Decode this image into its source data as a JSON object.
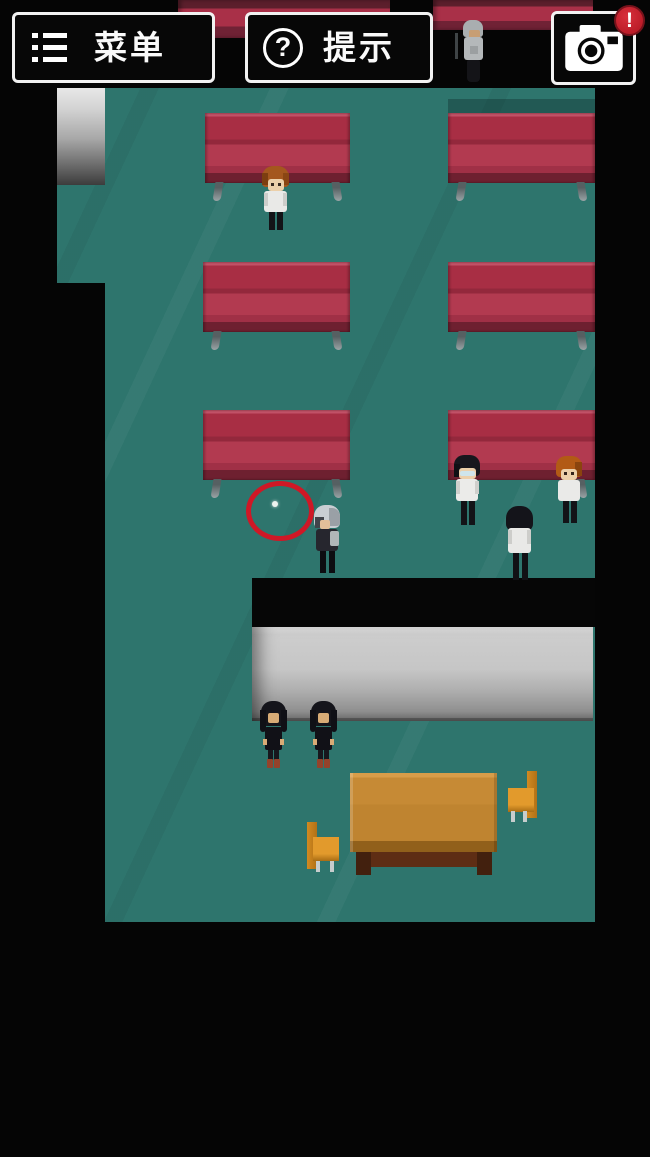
{
  "hud": {
    "menu_button": {
      "label": "菜单",
      "icon": "list-icon"
    },
    "hint_button": {
      "label": "提示",
      "icon": "question-circle-icon",
      "icon_char": "?"
    },
    "camera_button": {
      "icon": "camera-icon",
      "badge": "!"
    }
  },
  "palette": {
    "floor": "#2e756d",
    "bench_red": "#a82e44",
    "marker_red": "#cf1826",
    "wall_gray": "#c6c6c6",
    "table_wood": "#c68a35",
    "hud_border": "#f2f2f2",
    "badge_red": "#b01420"
  },
  "scene": {
    "benches": [
      {
        "name": "bench-top-left-partial",
        "x": 178,
        "y": 0,
        "w": 212,
        "h": 38,
        "partial": true
      },
      {
        "name": "bench-top-right-partial",
        "x": 433,
        "y": 0,
        "w": 160,
        "h": 30,
        "partial": true
      },
      {
        "name": "bench-row1-left",
        "x": 205,
        "y": 113,
        "w": 145
      },
      {
        "name": "bench-row1-right",
        "x": 448,
        "y": 113,
        "w": 147
      },
      {
        "name": "bench-row2-left",
        "x": 203,
        "y": 262,
        "w": 147
      },
      {
        "name": "bench-row2-right",
        "x": 448,
        "y": 262,
        "w": 147
      },
      {
        "name": "bench-row3-left",
        "x": 203,
        "y": 410,
        "w": 147
      },
      {
        "name": "bench-row3-right",
        "x": 448,
        "y": 410,
        "w": 147
      }
    ],
    "characters": [
      {
        "name": "npc-gray-hair-cane",
        "x": 460,
        "y": 20,
        "w": 26,
        "h": 62,
        "blocks": [
          [
            -5,
            13,
            3,
            26,
            "#3f4446",
            ""
          ],
          [
            3,
            0,
            20,
            17,
            "#a9aeb0",
            "8px 8px 3px 3px"
          ],
          [
            9,
            10,
            11,
            9,
            "#c79e74",
            "2px"
          ],
          [
            4,
            17,
            19,
            23,
            "#b4b8ba",
            "3px"
          ],
          [
            10,
            26,
            8,
            8,
            "#9b9fa1",
            ""
          ],
          [
            7,
            40,
            13,
            22,
            "#141418",
            "2px 2px 4px 4px"
          ]
        ]
      },
      {
        "name": "npc-brown-hair",
        "x": 261,
        "y": 166,
        "w": 29,
        "h": 66,
        "blocks": [
          [
            1,
            0,
            27,
            21,
            "#a4571e",
            "11px 11px 4px 4px"
          ],
          [
            1,
            7,
            6,
            12,
            "#7c3e10",
            ""
          ],
          [
            22,
            7,
            6,
            12,
            "#8a4614",
            ""
          ],
          [
            7,
            13,
            16,
            12,
            "#ecd0aa",
            "3px"
          ],
          [
            10,
            17,
            3,
            3,
            "#372a20",
            ""
          ],
          [
            17,
            17,
            3,
            3,
            "#372a20",
            ""
          ],
          [
            3,
            25,
            23,
            21,
            "#e9e9e7",
            "3px"
          ],
          [
            3,
            27,
            4,
            13,
            "#cdcdca",
            ""
          ],
          [
            22,
            27,
            4,
            13,
            "#cdcdca",
            ""
          ],
          [
            8,
            46,
            6,
            18,
            "#131317",
            ""
          ],
          [
            16,
            46,
            6,
            18,
            "#131317",
            ""
          ]
        ]
      },
      {
        "name": "player-silver-hair",
        "x": 312,
        "y": 505,
        "w": 30,
        "h": 68,
        "blocks": [
          [
            2,
            0,
            26,
            23,
            "#c9ced3",
            "11px 11px 5px 5px"
          ],
          [
            17,
            3,
            11,
            18,
            "#9aa0a6",
            "0 8px 3px 0"
          ],
          [
            3,
            12,
            9,
            11,
            "#41444b",
            ""
          ],
          [
            8,
            15,
            10,
            9,
            "#e2c09a",
            "2px"
          ],
          [
            4,
            24,
            22,
            22,
            "#26262e",
            "3px"
          ],
          [
            18,
            26,
            9,
            15,
            "#b0b6b8",
            "2px"
          ],
          [
            8,
            46,
            6,
            22,
            "#0d0d11",
            ""
          ],
          [
            17,
            46,
            6,
            22,
            "#0d0d11",
            ""
          ]
        ]
      },
      {
        "name": "npc-glasses",
        "x": 452,
        "y": 455,
        "w": 30,
        "h": 70,
        "blocks": [
          [
            2,
            0,
            26,
            21,
            "#17171d",
            "10px 10px 4px 4px"
          ],
          [
            2,
            9,
            6,
            13,
            "#101015",
            ""
          ],
          [
            7,
            13,
            17,
            11,
            "#ecd0aa",
            "3px"
          ],
          [
            8,
            16,
            15,
            5,
            "#cfe5eb",
            "2px"
          ],
          [
            4,
            24,
            22,
            22,
            "#ebebe9",
            "3px"
          ],
          [
            4,
            26,
            4,
            13,
            "#cfcfcc",
            ""
          ],
          [
            23,
            26,
            4,
            13,
            "#cfcfcc",
            ""
          ],
          [
            9,
            46,
            6,
            24,
            "#131317",
            ""
          ],
          [
            17,
            46,
            6,
            24,
            "#131317",
            ""
          ]
        ]
      },
      {
        "name": "npc-orange-hair",
        "x": 555,
        "y": 456,
        "w": 28,
        "h": 67,
        "blocks": [
          [
            1,
            0,
            26,
            21,
            "#b25a15",
            "10px 10px 4px 4px"
          ],
          [
            20,
            6,
            7,
            14,
            "#8a440e",
            ""
          ],
          [
            6,
            13,
            16,
            11,
            "#ecd0aa",
            "3px"
          ],
          [
            9,
            16,
            3,
            3,
            "#33241c",
            ""
          ],
          [
            16,
            16,
            3,
            3,
            "#33241c",
            ""
          ],
          [
            3,
            24,
            22,
            21,
            "#eaeae8",
            "3px"
          ],
          [
            8,
            45,
            6,
            22,
            "#131317",
            ""
          ],
          [
            16,
            45,
            6,
            22,
            "#131317",
            ""
          ]
        ]
      },
      {
        "name": "npc-back-view",
        "x": 504,
        "y": 506,
        "w": 31,
        "h": 74,
        "blocks": [
          [
            2,
            0,
            27,
            25,
            "#14141a",
            "12px 12px 7px 7px"
          ],
          [
            4,
            22,
            23,
            25,
            "#e9e9e7",
            "3px"
          ],
          [
            4,
            24,
            4,
            14,
            "#cdcdca",
            ""
          ],
          [
            23,
            24,
            4,
            14,
            "#cdcdca",
            ""
          ],
          [
            9,
            47,
            6,
            27,
            "#111115",
            ""
          ],
          [
            18,
            47,
            6,
            27,
            "#111115",
            ""
          ]
        ]
      },
      {
        "name": "npc-girl-black-dress-1",
        "x": 259,
        "y": 701,
        "w": 29,
        "h": 67,
        "blocks": [
          [
            2,
            0,
            25,
            25,
            "#15151b",
            "11px 11px 5px 5px"
          ],
          [
            1,
            9,
            6,
            22,
            "#101016",
            "0 0 3px 3px"
          ],
          [
            22,
            9,
            6,
            22,
            "#101016",
            "0 0 3px 3px"
          ],
          [
            9,
            12,
            11,
            10,
            "#d8ac76",
            "2px"
          ],
          [
            6,
            26,
            17,
            23,
            "#111117",
            "2px"
          ],
          [
            4,
            38,
            4,
            6,
            "#d8ac76",
            ""
          ],
          [
            21,
            38,
            4,
            6,
            "#d8ac76",
            ""
          ],
          [
            9,
            49,
            5,
            10,
            "#17171d",
            ""
          ],
          [
            15,
            49,
            5,
            10,
            "#17171d",
            ""
          ],
          [
            8,
            58,
            6,
            9,
            "#94432b",
            "1px"
          ],
          [
            15,
            58,
            6,
            9,
            "#94432b",
            "1px"
          ]
        ]
      },
      {
        "name": "npc-girl-black-dress-2",
        "x": 309,
        "y": 701,
        "w": 29,
        "h": 67,
        "blocks": [
          [
            2,
            0,
            25,
            25,
            "#15151b",
            "11px 11px 5px 5px"
          ],
          [
            1,
            9,
            6,
            22,
            "#101016",
            "0 0 3px 3px"
          ],
          [
            22,
            9,
            6,
            22,
            "#101016",
            "0 0 3px 3px"
          ],
          [
            9,
            12,
            11,
            10,
            "#d8ac76",
            "2px"
          ],
          [
            6,
            26,
            17,
            23,
            "#111117",
            "2px"
          ],
          [
            4,
            38,
            4,
            6,
            "#d8ac76",
            ""
          ],
          [
            21,
            38,
            4,
            6,
            "#d8ac76",
            ""
          ],
          [
            9,
            49,
            5,
            10,
            "#17171d",
            ""
          ],
          [
            15,
            49,
            5,
            10,
            "#17171d",
            ""
          ],
          [
            8,
            58,
            6,
            9,
            "#94432b",
            "1px"
          ],
          [
            15,
            58,
            6,
            9,
            "#94432b",
            "1px"
          ]
        ]
      }
    ],
    "marker": {
      "name": "item-highlight-circle"
    }
  }
}
